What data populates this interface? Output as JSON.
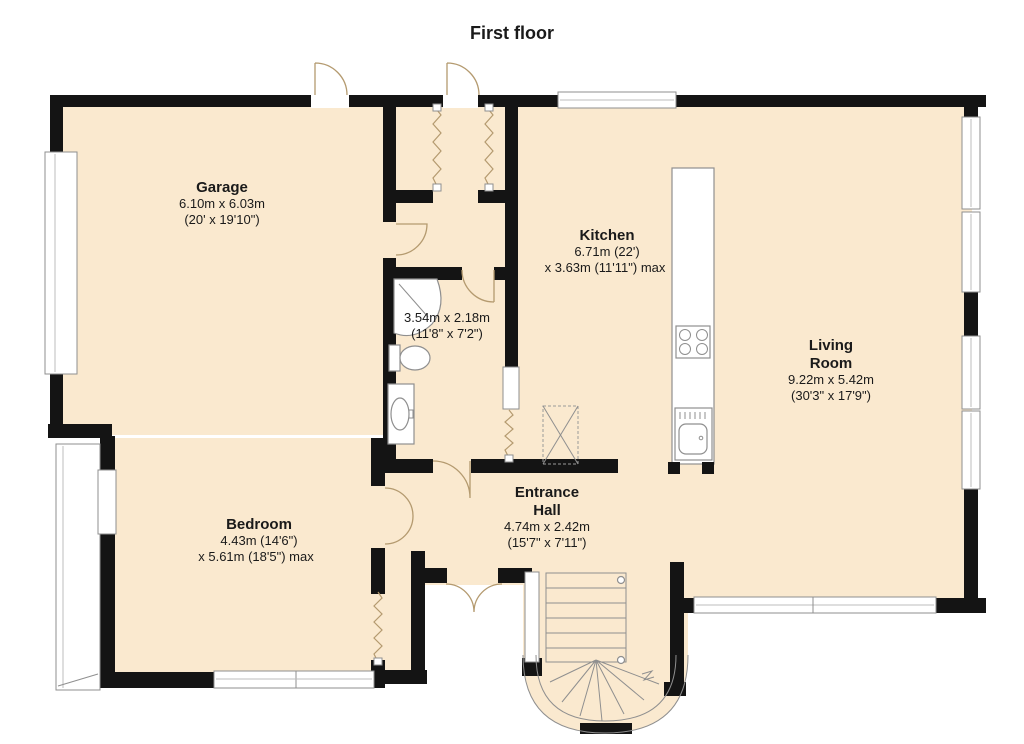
{
  "title": "First floor",
  "rooms": {
    "garage": {
      "name": "Garage",
      "dim1": "6.10m x 6.03m",
      "dim2": "(20' x 19'10\")"
    },
    "kitchen": {
      "name": "Kitchen",
      "dim1": "6.71m (22')",
      "dim2": "x 3.63m (11'11\") max"
    },
    "living_room": {
      "name1": "Living",
      "name2": "Room",
      "dim1": "9.22m x 5.42m",
      "dim2": "(30'3\" x 17'9\")"
    },
    "bedroom": {
      "name": "Bedroom",
      "dim1": "4.43m (14'6\")",
      "dim2": "x 5.61m (18'5\") max"
    },
    "entrance_hall": {
      "name1": "Entrance",
      "name2": "Hall",
      "dim1": "4.74m x 2.42m",
      "dim2": "(15'7\" x 7'11\")"
    },
    "bathroom": {
      "dim1": "3.54m x 2.18m",
      "dim2": "(11'8\" x 7'2\")"
    }
  },
  "colors": {
    "floor": "#FAE9CF",
    "wall": "#141414",
    "window_frame": "#8F8F8F",
    "door_swing": "#B49A6F",
    "text": "#1A1A1A"
  }
}
